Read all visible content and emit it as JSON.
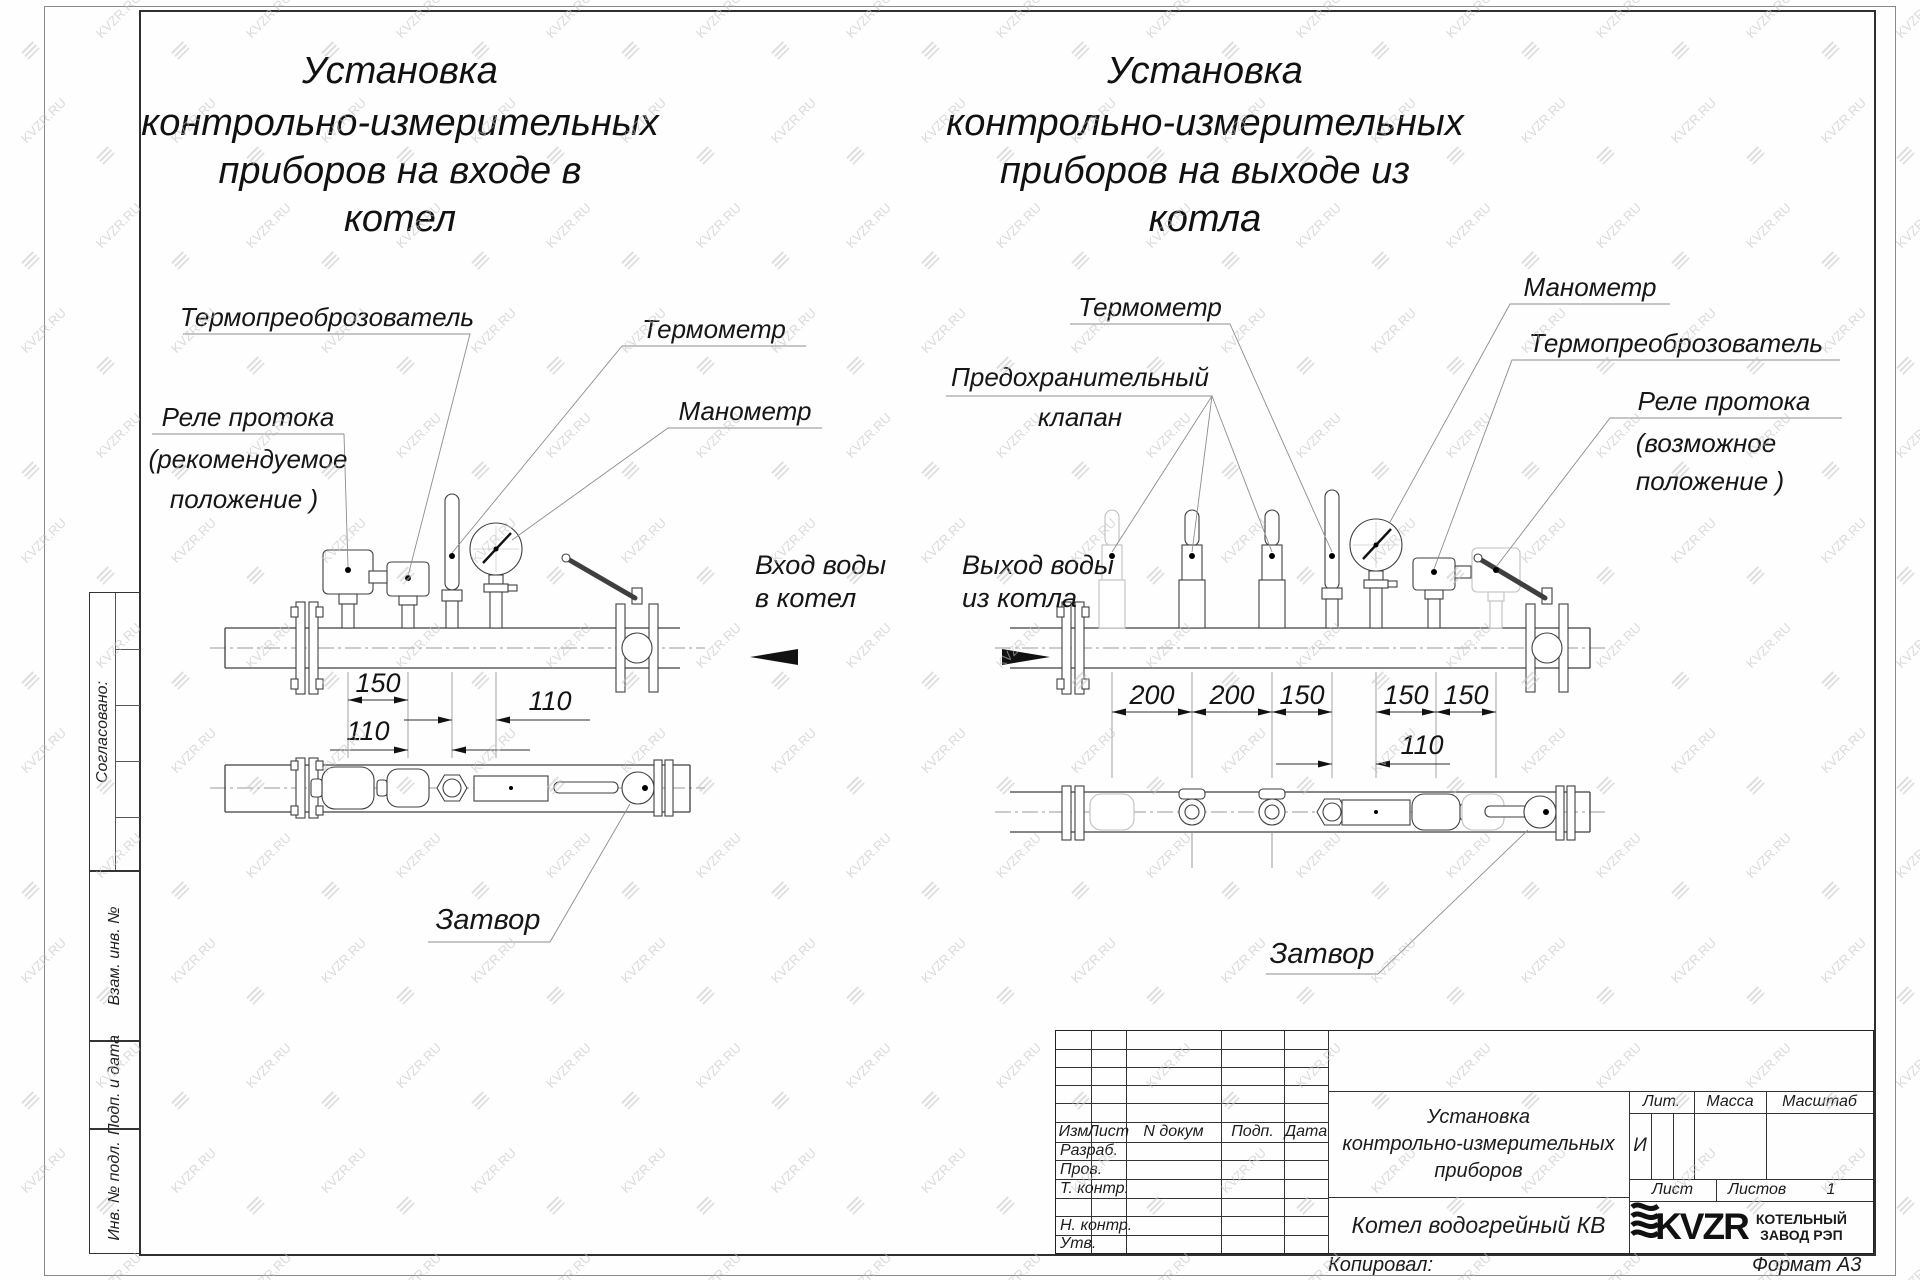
{
  "watermark": {
    "text": "KVZR.RU"
  },
  "titles": {
    "left": [
      "Установка",
      "контрольно-измерительных",
      "приборов на входе в",
      "котел"
    ],
    "right": [
      "Установка",
      "контрольно-измерительных",
      "приборов на выходе из",
      "котла"
    ]
  },
  "labels": {
    "left": {
      "transducer": "Термопреоброзователь",
      "thermometer": "Термометр",
      "manometer": "Манометр",
      "relay1": "Реле протока",
      "relay2": "(рекомендуемое",
      "relay3": "положение )",
      "flow1": "Вход воды",
      "flow2": "в котел",
      "valve": "Затвор"
    },
    "right": {
      "thermometer": "Термометр",
      "safety1": "Предохранительный",
      "safety2": "клапан",
      "manometer": "Манометр",
      "transducer": "Термопреоброзователь",
      "relay1": "Реле протока",
      "relay2": "(возможное",
      "relay3": "положение )",
      "flow1": "Выход воды",
      "flow2": "из котла",
      "valve": "Затвор"
    }
  },
  "dims": {
    "left": {
      "a": "150",
      "b": "110",
      "c": "110"
    },
    "right": {
      "a": "200",
      "b": "200",
      "c": "150",
      "d": "150",
      "e": "150",
      "f": "110"
    }
  },
  "sidebar": {
    "agreed": "Согласовано:",
    "vzam": "Взам. инв. №",
    "podp": "Подп. и дата",
    "inv": "Инв. № подл."
  },
  "tb": {
    "izm": "Изм",
    "list": "Лист",
    "ndok": "N докум",
    "podp": "Подп.",
    "data": "Дата",
    "razrab": "Разраб.",
    "prov": "Пров.",
    "tkontr": "Т. контр.",
    "nkontr": "Н. контр.",
    "utv": "Утв.",
    "t1": "Установка",
    "t2": "контрольно-измерительных",
    "t3": "приборов",
    "product": "Котел водогрейный КВ",
    "lit": "Лит.",
    "massa": "Масса",
    "scale": "Масштаб",
    "lit_val": "И",
    "sheet": "Лист",
    "sheets": "Листов",
    "sheets_val": "1",
    "logo": "KVZR",
    "logo1": "КОТЕЛЬНЫЙ",
    "logo2": "ЗАВОД РЭП",
    "copied": "Копировал:",
    "format": "Формат А3"
  }
}
